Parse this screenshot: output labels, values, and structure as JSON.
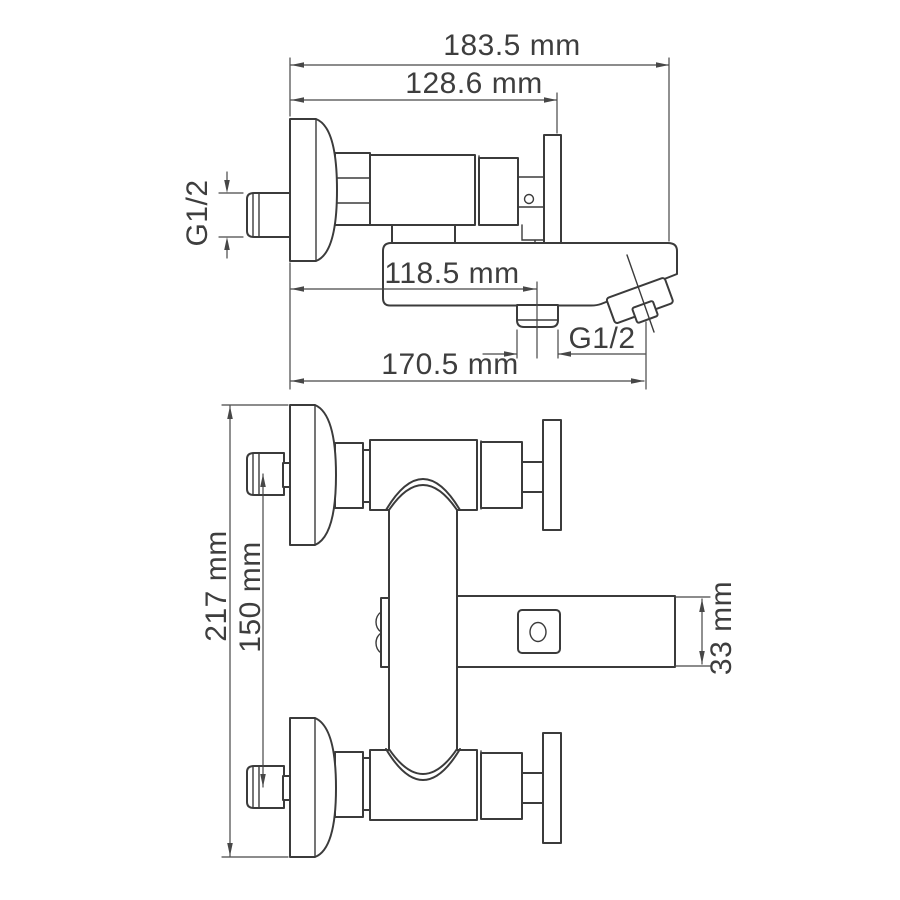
{
  "drawing": {
    "description": "Technical dimension drawing of a wall-mounted bath/shower mixer faucet, two orthographic views",
    "colors": {
      "background": "#ffffff",
      "part_line": "#3b3b3b",
      "dimension_line": "#474747",
      "text": "#3e3e3e"
    },
    "side_view": {
      "width_total": "183.5 mm",
      "width_to_wall_plate": "128.6 mm",
      "inlet_thread": "G1/2",
      "spout_reach": "118.5 mm",
      "outlet_thread": "G1/2",
      "reach_total": "170.5 mm"
    },
    "front_view": {
      "height_total": "217 mm",
      "inlet_spacing": "150 mm",
      "spout_height": "33 mm"
    }
  }
}
